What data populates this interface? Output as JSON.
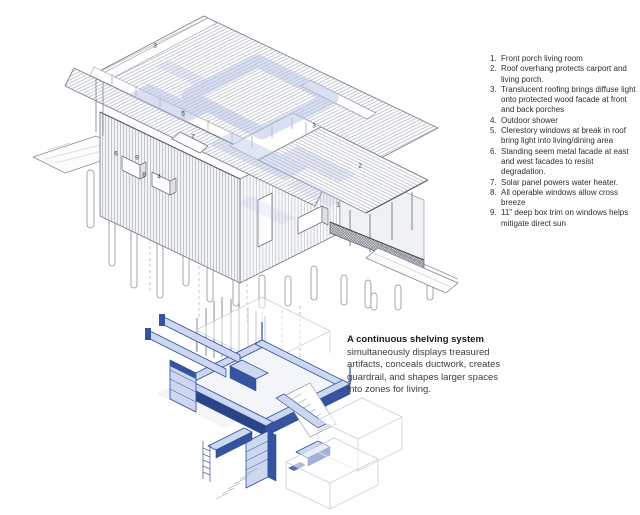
{
  "figure": {
    "type": "architectural axonometric diagram",
    "views": [
      "house exterior axonometric",
      "interior shelving axonometric"
    ]
  },
  "annotations": {
    "items": [
      {
        "num": "1.",
        "text": "Front porch living room"
      },
      {
        "num": "2.",
        "text": "Roof overhang protects carport and living porch."
      },
      {
        "num": "3.",
        "text": "Translucent roofing brings diffuse light onto protected wood facade at front and back porches"
      },
      {
        "num": "4.",
        "text": "Outdoor shower"
      },
      {
        "num": "5.",
        "text": "Clerestory windows at break in roof bring light into living/dining area"
      },
      {
        "num": "6.",
        "text": "Standing seem metal facade at east and west facades to resist degradation."
      },
      {
        "num": "7.",
        "text": "Solar panel powers water heater."
      },
      {
        "num": "8.",
        "text": "All operable windows allow cross breeze"
      },
      {
        "num": "9.",
        "text": "11\" deep box trim on windows helps mitigate direct sun"
      }
    ]
  },
  "caption": {
    "heading": "A continuous shelving system",
    "body": "simultaneously displays treasured artifacts, conceals ductwork, creates guardrail, and shapes larger spaces into zones for living."
  },
  "labels": [
    {
      "n": "3"
    },
    {
      "n": "5"
    },
    {
      "n": "7"
    },
    {
      "n": "3"
    },
    {
      "n": "2"
    },
    {
      "n": "1"
    },
    {
      "n": "6"
    },
    {
      "n": "9"
    },
    {
      "n": "8"
    },
    {
      "n": "4"
    }
  ],
  "colors": {
    "line_gray": "#7d828c",
    "hatch_gray": "#aab0bb",
    "dark_seam": "#4a4e55",
    "accent_blue": "#2e4d9c",
    "accent_blue_light": "#cdd7ef",
    "accent_blue_dark": "#35539f",
    "watermark_blue": "#b4c1e4",
    "ghost_line": "#c7cbd9",
    "text": "#2e2e2e"
  }
}
